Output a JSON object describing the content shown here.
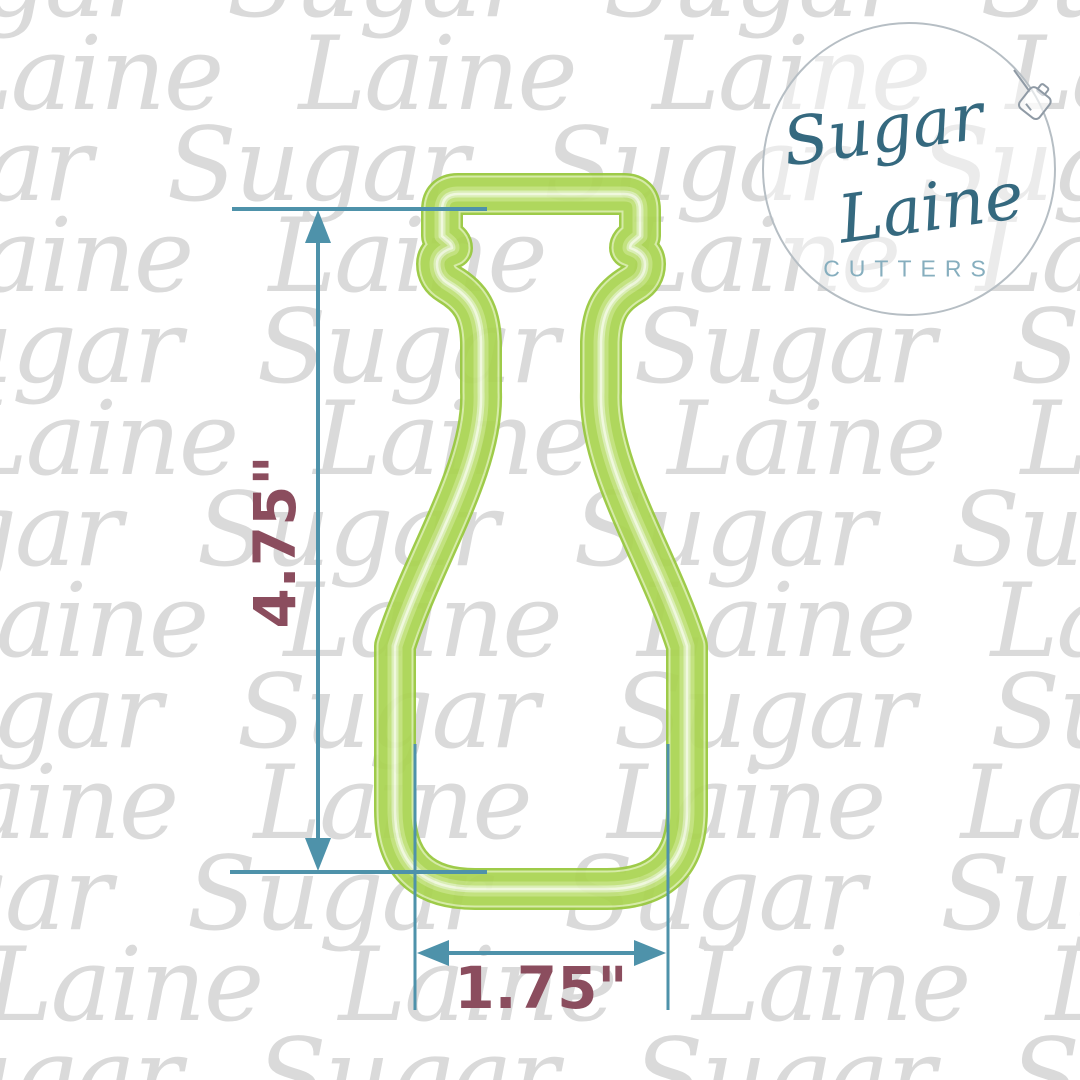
{
  "watermark": {
    "color": "#dadada",
    "rows": [
      {
        "word": "Sugar",
        "x": -150,
        "y": -18
      },
      {
        "word": "Laine",
        "x": -55,
        "y": 75
      },
      {
        "word": "Sugar",
        "x": -210,
        "y": 166
      },
      {
        "word": "Laine",
        "x": -85,
        "y": 257
      },
      {
        "word": "Sugar",
        "x": -120,
        "y": 348
      },
      {
        "word": "Laine",
        "x": -40,
        "y": 440
      },
      {
        "word": "Sugar",
        "x": -180,
        "y": 531
      },
      {
        "word": "Laine",
        "x": -70,
        "y": 622
      },
      {
        "word": "Sugar",
        "x": -140,
        "y": 713
      },
      {
        "word": "Laine",
        "x": -100,
        "y": 804
      },
      {
        "word": "Sugar",
        "x": -190,
        "y": 895
      },
      {
        "word": "Laine",
        "x": -15,
        "y": 986
      },
      {
        "word": "Sugar",
        "x": -120,
        "y": 1077
      }
    ]
  },
  "cutter": {
    "shape": "milk-bottle-cookie-cutter",
    "streaks": [
      {
        "color": "#97c83c"
      },
      {
        "color": "#d3eaa2"
      },
      {
        "color": "#aad451"
      },
      {
        "color": "#bfe077"
      },
      {
        "color": "#d8edb0"
      },
      {
        "color": "#eff8dc"
      }
    ]
  },
  "dimensions": {
    "height_label": "4.75\"",
    "width_label": "1.75\"",
    "line_color": "#4e92aa",
    "label_color": "#8b4d5e"
  },
  "logo": {
    "brand_line1": "Sugar",
    "brand_line2": "Laine",
    "brand_line3": "CUTTERS",
    "script_color": "#35697f",
    "cutters_color": "#86aebe",
    "border_color": "#b6bec4"
  }
}
